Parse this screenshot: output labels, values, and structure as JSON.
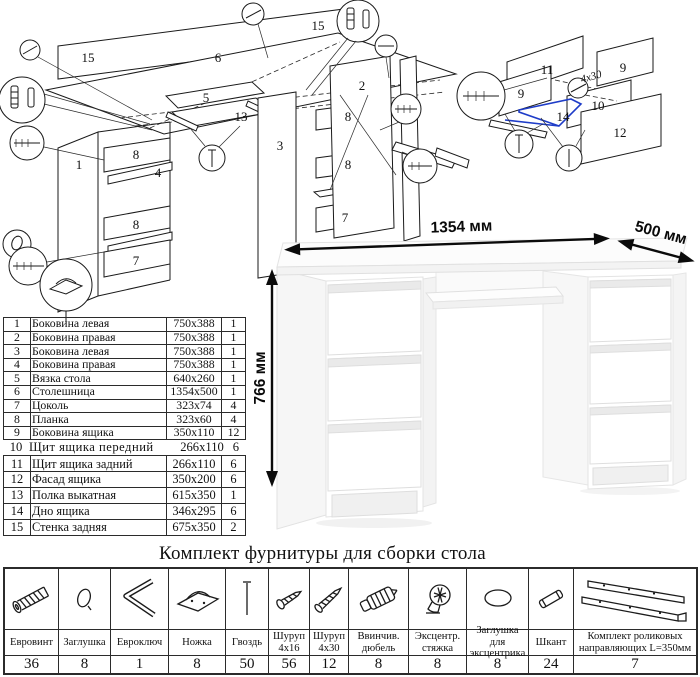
{
  "diagram_main": {
    "labels": {
      "p15a": "15",
      "p15b": "15",
      "p6": "6",
      "p5": "5",
      "p13": "13",
      "p1": "1",
      "p2": "2",
      "p3": "3",
      "p4": "4",
      "p8a": "8",
      "p8b": "8",
      "p8c": "8",
      "p8d": "8",
      "p7a": "7",
      "p7b": "7"
    }
  },
  "diagram_drawer": {
    "labels": {
      "p11": "11",
      "p9a": "9",
      "p9b": "9",
      "p10": "10",
      "p14": "14",
      "p12": "12"
    },
    "screw_note": "4x30"
  },
  "desk": {
    "width_label": "1354 мм",
    "depth_label": "500 мм",
    "height_label": "766 мм"
  },
  "parts_table": {
    "rows": [
      {
        "num": "1",
        "name": "Боковина левая",
        "size": "750x388",
        "qty": "1"
      },
      {
        "num": "2",
        "name": "Боковина правая",
        "size": "750x388",
        "qty": "1"
      },
      {
        "num": "3",
        "name": "Боковина левая",
        "size": "750x388",
        "qty": "1"
      },
      {
        "num": "4",
        "name": "Боковина правая",
        "size": "750x388",
        "qty": "1"
      },
      {
        "num": "5",
        "name": "Вязка стола",
        "size": "640x260",
        "qty": "1"
      },
      {
        "num": "6",
        "name": "Столешница",
        "size": "1354x500",
        "qty": "1"
      },
      {
        "num": "7",
        "name": "Цоколь",
        "size": "323x74",
        "qty": "4"
      },
      {
        "num": "8",
        "name": "Планка",
        "size": "323x60",
        "qty": "4"
      },
      {
        "num": "9",
        "name": "Боковина ящика",
        "size": "350x110",
        "qty": "12"
      },
      {
        "num": "10",
        "name": "Щит ящика передний",
        "size": "266x110",
        "qty": "6"
      },
      {
        "num": "11",
        "name": "Щит ящика задний",
        "size": "266x110",
        "qty": "6"
      },
      {
        "num": "12",
        "name": "Фасад ящика",
        "size": "350x200",
        "qty": "6"
      },
      {
        "num": "13",
        "name": "Полка выкатная",
        "size": "615x350",
        "qty": "1"
      },
      {
        "num": "14",
        "name": "Дно ящика",
        "size": "346x295",
        "qty": "6"
      },
      {
        "num": "15",
        "name": "Стенка задняя",
        "size": "675x350",
        "qty": "2"
      }
    ]
  },
  "hardware": {
    "title": "Комплект фурнитуры для сборки стола",
    "items": [
      {
        "name": "Евровинт",
        "qty": "36",
        "icon": "euro-screw"
      },
      {
        "name": "Заглушка",
        "qty": "8",
        "icon": "cap"
      },
      {
        "name": "Евроключ",
        "qty": "1",
        "icon": "hex-key"
      },
      {
        "name": "Ножка",
        "qty": "8",
        "icon": "foot"
      },
      {
        "name": "Гвоздь",
        "qty": "50",
        "icon": "nail"
      },
      {
        "name": "Шуруп 4x16",
        "qty": "56",
        "icon": "screw-small"
      },
      {
        "name": "Шуруп 4x30",
        "qty": "12",
        "icon": "screw-long"
      },
      {
        "name": "Ввинчив. дюбель",
        "qty": "8",
        "icon": "screw-in-dowel"
      },
      {
        "name": "Эксцентр. стяжка",
        "qty": "8",
        "icon": "cam-lock"
      },
      {
        "name": "Заглушка для эксцентрика",
        "qty": "8",
        "icon": "cam-cap"
      },
      {
        "name": "Шкант",
        "qty": "24",
        "icon": "wood-dowel"
      },
      {
        "name": "Комплект роликовых направляющих L=350мм",
        "qty": "7",
        "icon": "drawer-slides"
      }
    ]
  }
}
